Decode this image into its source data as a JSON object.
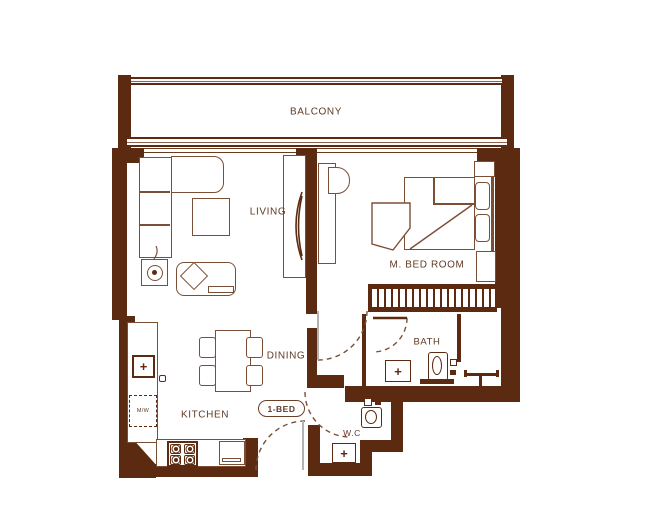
{
  "plan": {
    "unit_badge": "1-BED",
    "rooms": {
      "balcony": "BALCONY",
      "living": "LIVING",
      "master_bedroom": "M. BED ROOM",
      "dining": "DINING",
      "kitchen": "KITCHEN",
      "bath": "BATH",
      "wc": "W.C"
    },
    "appliances": {
      "microwave": "M/W"
    },
    "colors": {
      "wall": "#5b2a10",
      "furniture_line": "#7b4f35",
      "text": "#5f3a26",
      "background": "#ffffff"
    }
  }
}
